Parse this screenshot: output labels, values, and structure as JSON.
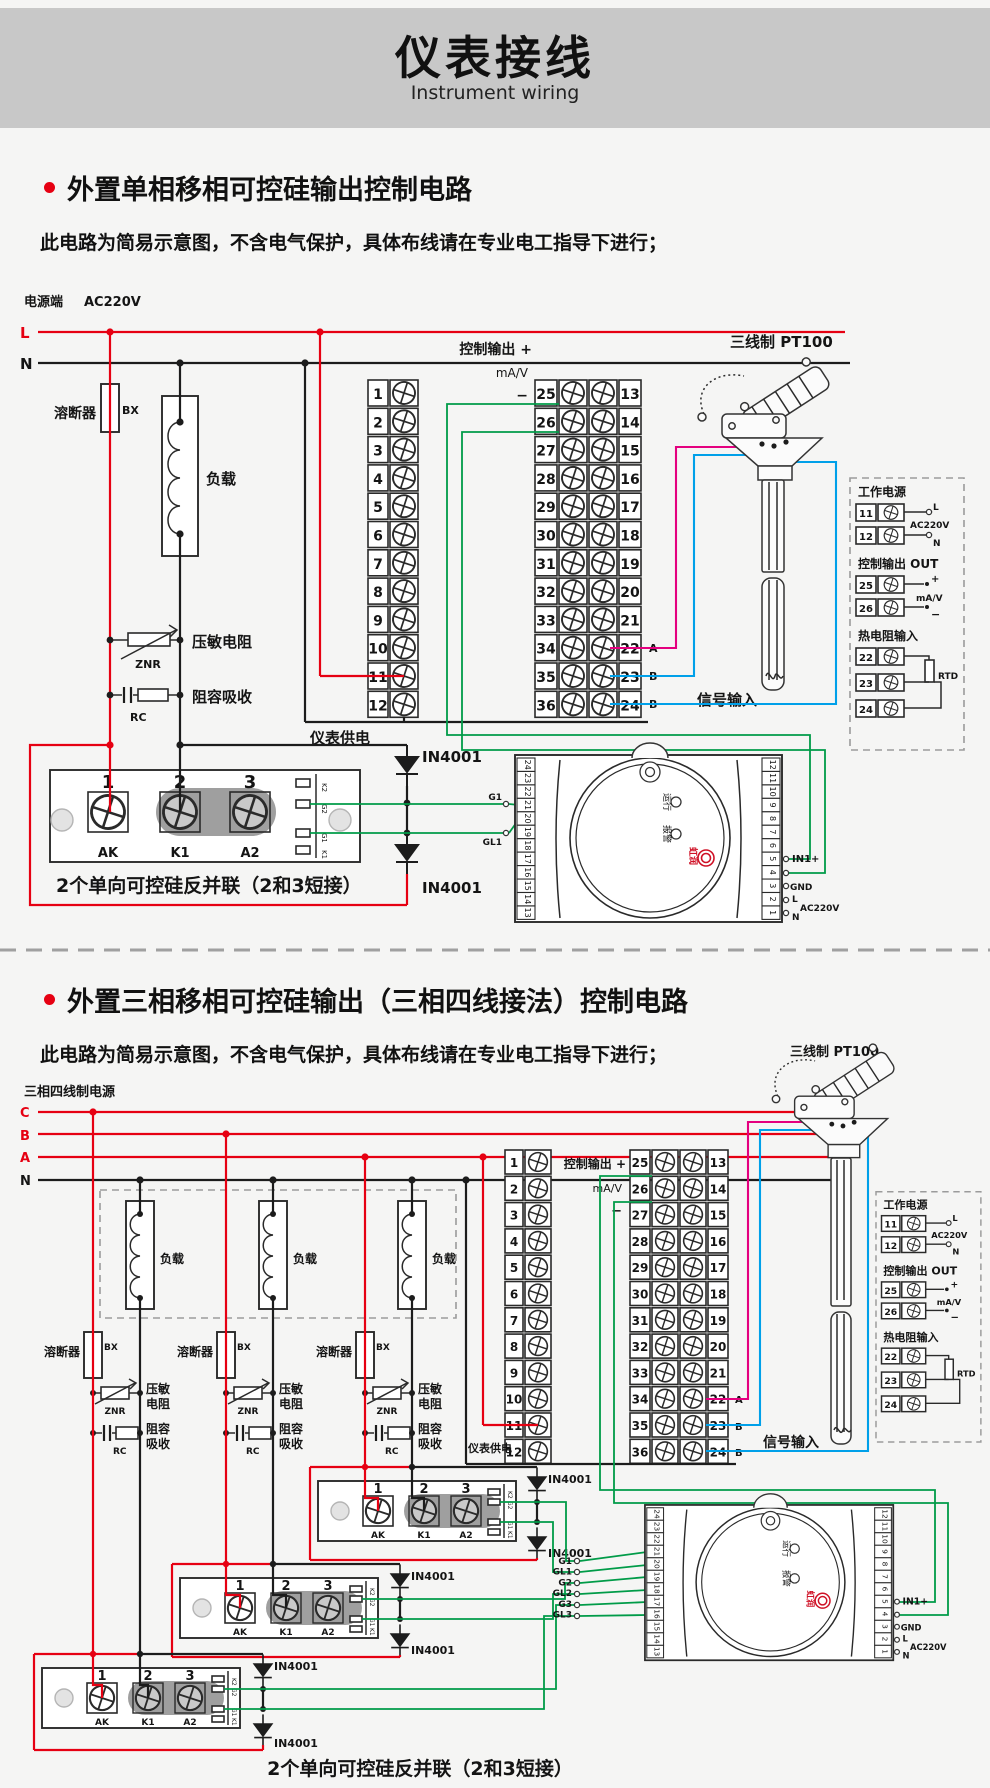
{
  "header": {
    "title": "仪表接线",
    "subtitle": "Instrument wiring"
  },
  "common": {
    "warning": "此电路为简易示意图，不含电气保护，具体布线请在专业电工指导下进行；",
    "caption": "2个单向可控硅反并联（2和3短接）",
    "diode": "IN4001",
    "fuse": "溶断器",
    "bx": "BX",
    "load": "负载",
    "varistor": "压敏电阻",
    "varistor_l1": "压敏",
    "varistor_l2": "电阻",
    "znr": "ZNR",
    "snubber": "阻容吸收",
    "snubber_l1": "阻容",
    "snubber_l2": "吸收",
    "rc": "RC",
    "supply": "仪表供电",
    "ctrl_out": "控制输出 +",
    "mav": "mA/V",
    "minus": "−",
    "plus": "+",
    "pt100": "三线制 PT100",
    "signal": "信号输入",
    "a": "A",
    "b": "B",
    "run": "运行",
    "alarm": "报警",
    "brand": "虹润",
    "in1": "IN1+",
    "gnd": "GND",
    "l": "L",
    "n": "N",
    "ac": "AC220V",
    "scr_nums": [
      "1",
      "2",
      "3"
    ],
    "scr_pins": [
      "AK",
      "K1",
      "A2"
    ],
    "scr_strip": [
      "K2",
      "G2",
      "G1",
      "K1"
    ],
    "panel": {
      "power": "工作电源",
      "out": "控制输出 OUT",
      "rtd_in": "热电阻输入",
      "rtd": "RTD",
      "n11": "11",
      "n12": "12",
      "n25": "25",
      "n26": "26",
      "n22": "22",
      "n23": "23",
      "n24": "24"
    }
  },
  "terminals": {
    "left": [
      "1",
      "2",
      "3",
      "4",
      "5",
      "6",
      "7",
      "8",
      "9",
      "10",
      "11",
      "12"
    ],
    "pairs": [
      {
        "a": "25",
        "b": "13"
      },
      {
        "a": "26",
        "b": "14"
      },
      {
        "a": "27",
        "b": "15"
      },
      {
        "a": "28",
        "b": "16"
      },
      {
        "a": "29",
        "b": "17"
      },
      {
        "a": "30",
        "b": "18"
      },
      {
        "a": "31",
        "b": "19"
      },
      {
        "a": "32",
        "b": "20"
      },
      {
        "a": "33",
        "b": "21"
      },
      {
        "a": "34",
        "b": "22"
      },
      {
        "a": "35",
        "b": "23"
      },
      {
        "a": "36",
        "b": "24"
      }
    ]
  },
  "meter": {
    "left": [
      "24",
      "23",
      "22",
      "21",
      "20",
      "19",
      "18",
      "17",
      "16",
      "15",
      "14",
      "13"
    ],
    "right": [
      "12",
      "11",
      "10",
      "9",
      "8",
      "7",
      "6",
      "5",
      "4",
      "3",
      "2",
      "1"
    ]
  },
  "section1": {
    "title": "外置单相移相可控硅输出控制电路",
    "power": "电源端",
    "voltage": "AC220V",
    "l": "L",
    "n": "N",
    "g1": "G1",
    "gl1": "GL1"
  },
  "section2": {
    "title": "外置三相移相可控硅输出（三相四线接法）控制电路",
    "power": "三相四线制电源",
    "phases": [
      "C",
      "B",
      "A",
      "N"
    ],
    "gates": [
      "G1",
      "GL1",
      "G2",
      "GL2",
      "G3",
      "GL3"
    ]
  }
}
